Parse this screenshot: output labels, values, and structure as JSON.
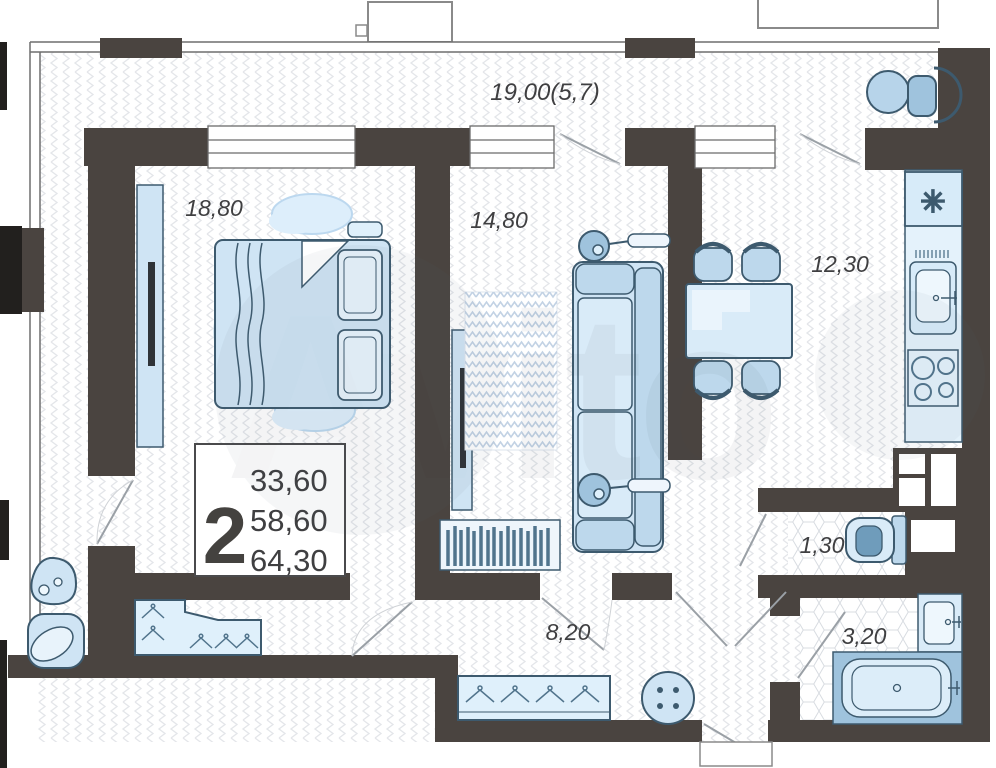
{
  "plan_title": "2-room apartment floor plan",
  "watermark": {
    "brand": "Avito"
  },
  "rooms": {
    "balcony": {
      "area": "19,00(5,7)"
    },
    "bedroom": {
      "area": "18,80"
    },
    "living": {
      "area": "14,80"
    },
    "kitchen": {
      "area": "12,30"
    },
    "hallway": {
      "area": "8,20"
    },
    "wc": {
      "area": "1,30"
    },
    "bathroom": {
      "area": "3,20"
    }
  },
  "stats": {
    "rooms_count": "2",
    "lines": [
      "33,60",
      "58,60",
      "64,30"
    ]
  },
  "icons": {
    "fridge_symbol": "✳"
  },
  "colors": {
    "wall": "#4a4440",
    "furniture_fill": "#cfe4f4",
    "furniture_fill_light": "#dff0fb",
    "furniture_accent": "#9fc3dd",
    "furniture_stroke": "#3d5a6e",
    "hatch": "#e3e5e9",
    "label_text": "#3f3f41"
  }
}
